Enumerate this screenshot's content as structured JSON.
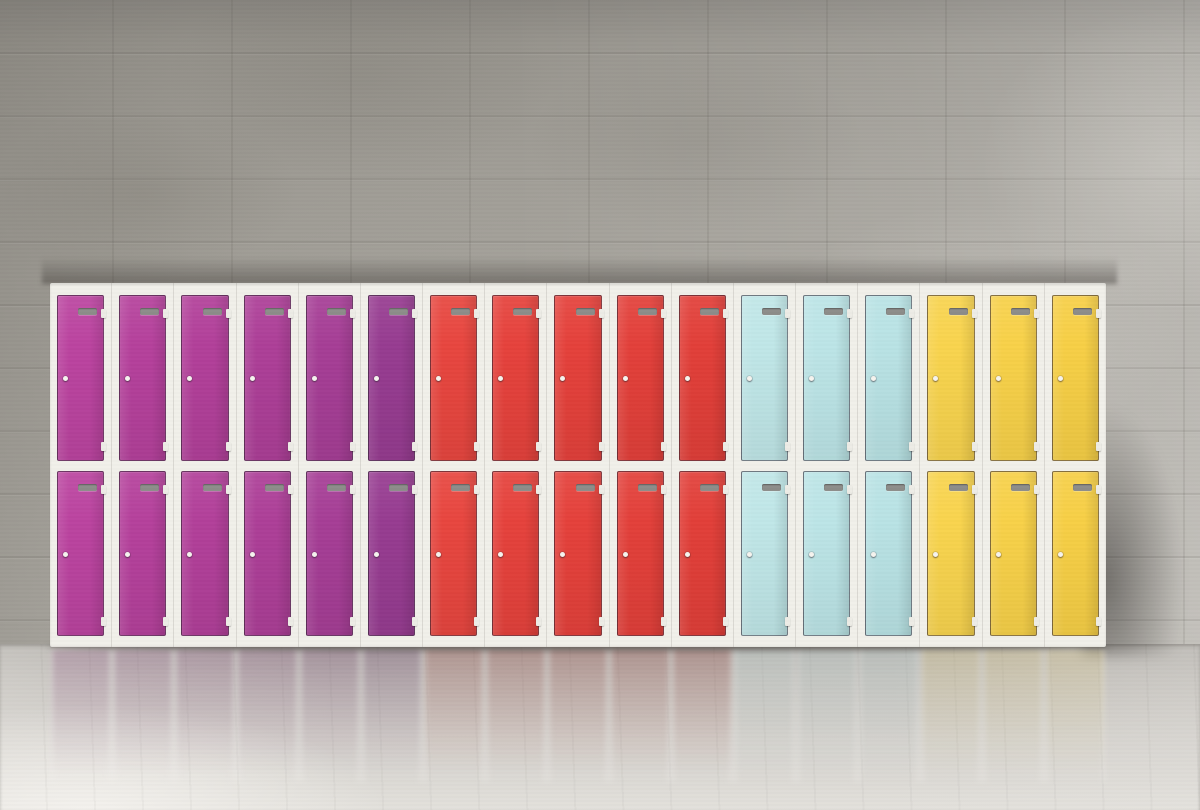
{
  "scene": {
    "type": "photograph",
    "description": "Seventeen columns of colourful two-tier storage lockers standing against a board-formed concrete wall on a polished reflective floor",
    "locker_unit": {
      "tiers": 2,
      "total_columns": 17,
      "frame_color": "#f1f0ea",
      "door_outline_color": "#322634",
      "vent_color": "#8d8d8a",
      "keyhole_color": "#f6f4ef",
      "groups": [
        {
          "name": "magenta",
          "columns": 6,
          "door_color": "#b2409a",
          "shades": [
            "#bb44a0",
            "#b5419c",
            "#b2409a",
            "#ad3f98",
            "#a63e96",
            "#973c91"
          ]
        },
        {
          "name": "red",
          "columns": 5,
          "door_color": "#e5423c",
          "shades": [
            "#e8463f",
            "#e6423c",
            "#e5413b",
            "#e3403a",
            "#e23f39"
          ]
        },
        {
          "name": "cyan",
          "columns": 3,
          "door_color": "#bce5e7",
          "shades": [
            "#c0e7e8",
            "#bce5e7",
            "#b9e3e5"
          ]
        },
        {
          "name": "yellow",
          "columns": 3,
          "door_color": "#f8d24b",
          "shades": [
            "#f9d44e",
            "#f8d149",
            "#f7cf46"
          ]
        }
      ],
      "features_per_door": [
        "vent-slot",
        "keyhole",
        "hinge-top",
        "hinge-bottom"
      ]
    },
    "environment": {
      "wall_color": "#a5a29b",
      "wall_highlight_color": "#c3c0ba",
      "wall_shadow_color": "#302d2a",
      "floor_color_near": "#b1aea9",
      "floor_color_far": "#e3e1dc",
      "reflection_opacity": 0.75
    }
  }
}
